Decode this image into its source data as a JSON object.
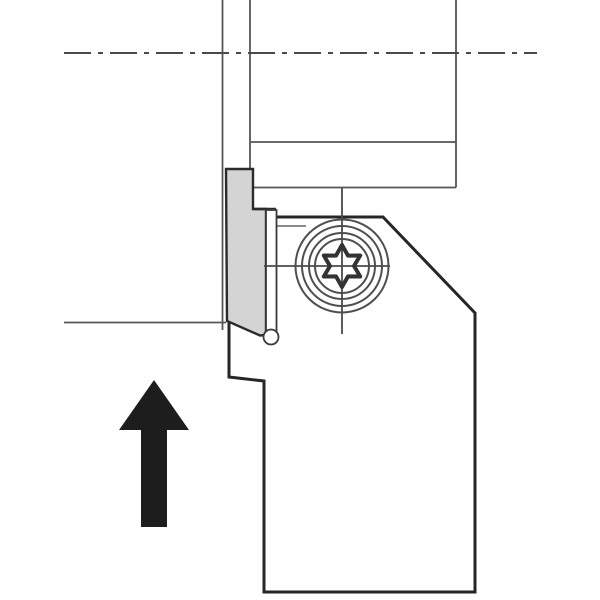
{
  "diagram": {
    "kind": "technical-line-drawing",
    "description": "Side view of a grooving / parting tool holder with gray insert clamp, torx clamp screw, workpiece outline with dash-dot rotation axis, and a solid black upward feed-direction arrow.",
    "colors": {
      "background": "#ffffff",
      "thin_line": "#555555",
      "thick_outline": "#262626",
      "clamp_fill": "#d4d4d4",
      "insert_fill": "#ffffff",
      "arrow_fill": "#1d1d1d",
      "centerline": "#4a4a4a"
    },
    "components": [
      "workpiece-axis-centerline",
      "workpiece-groove-walls",
      "workpiece-outline",
      "tool-body",
      "insert-clamp",
      "insert-finger",
      "insert-nose",
      "clamp-screw-torx",
      "feed-direction-arrow"
    ],
    "arrow": {
      "direction": "up"
    },
    "geometry": {
      "axis_centerline_y": 53,
      "axis_centerline_x_range": [
        64,
        537
      ],
      "groove_wall_x": [
        222.5,
        250
      ],
      "workpiece_right_face_x": 456,
      "workpiece_line_y": [
        142,
        187.5
      ],
      "workpiece_od_left_y": 322.5,
      "od_left_x_range": [
        64,
        226
      ],
      "screw_center": [
        342,
        266
      ],
      "screw_ring_radii": [
        46.5,
        40,
        33,
        27
      ],
      "torx_outer_radius": 21,
      "torx_inner_radius": 12,
      "body_top_y": 217,
      "bevel_from": [
        383,
        217
      ],
      "bevel_to": [
        475,
        313
      ],
      "body_right_x": 475,
      "body_bottom_y": 592,
      "body_left_x": 264,
      "arrow_tip": [
        154,
        380
      ],
      "arrow_head_width": 70,
      "arrow_stem": [
        141,
        167,
        527
      ]
    }
  }
}
